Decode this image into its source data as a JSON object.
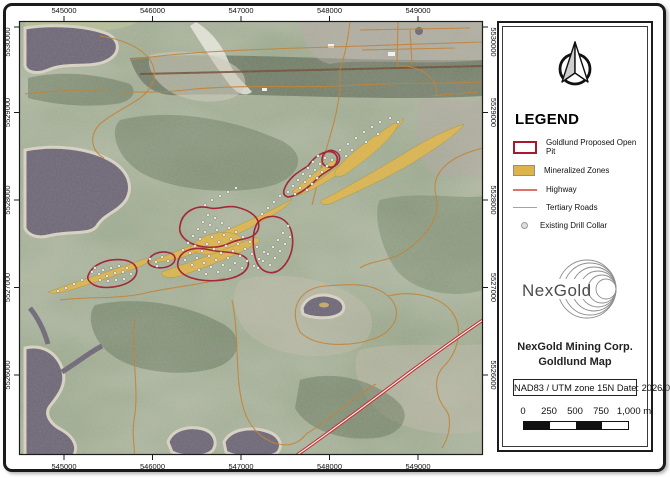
{
  "map": {
    "x_labels": [
      "545000",
      "546000",
      "547000",
      "548000",
      "549000"
    ],
    "y_labels": [
      "5530000",
      "5529000",
      "5528000",
      "5527000",
      "5526000"
    ],
    "features": {
      "tertiary_roads": [
        "M25,94 C80,86 130,96 185,90 C240,84 300,88 340,86 C400,82 450,84 483,82",
        "M130,60 C180,52 240,50 300,48 C360,46 420,44 483,42",
        "M100,36 C140,42 162,62 152,84 C144,102 118,108 100,124 C88,136 92,152 104,158",
        "M350,21 C348,40 344,58 340,70 L340,88 C338,110 332,130 326,150 C320,170 316,190 312,205",
        "M398,21 L397,66 C420,64 440,80 436,96",
        "M360,30 L470,28 M362,50 L455,48 M410,30 L412,64 M430,96 L478,92",
        "M483,148 C450,156 430,172 436,196 C442,218 424,238 404,252 C388,262 372,260 360,268",
        "M300,332 C288,308 300,288 325,286 C350,284 372,282 388,296 C404,310 396,330 376,338 C352,347 316,348 300,332",
        "M388,296 C412,290 440,296 452,312 C464,328 458,352 444,366 C432,378 436,398 446,410 C452,418 450,436 442,448",
        "M135,318 C130,352 140,388 134,420 C131,438 136,450 134,455",
        "M232,300 C240,338 234,378 244,410 C250,428 262,440 278,444 C292,447 300,442 306,434",
        "M306,434 C330,420 352,398 376,384",
        "M60,300 C90,296 120,300 150,292 C180,286 205,284 225,278"
      ],
      "highway": "M297,455 C330,432 370,402 410,372 C440,350 462,334 483,320",
      "mineralized_zones": [
        "M48,292 C70,284 100,274 130,264 C142,260 152,256 150,260 C146,266 120,274 96,282 C74,289 56,296 48,292 Z",
        "M150,262 C180,250 215,236 250,220 C268,212 288,202 292,199 C288,208 262,222 230,238 C198,254 166,264 150,262 Z",
        "M190,248 C200,234 220,230 236,234 C246,238 244,248 232,252 C216,257 196,256 190,248 Z",
        "M162,272 C190,262 220,252 248,240 C258,236 264,238 256,244 C236,256 204,268 180,276 C170,279 160,277 162,272 Z",
        "M296,196 C320,180 344,162 368,144 C380,134 396,124 404,118 C400,128 384,142 362,158 C340,174 312,192 296,196 Z",
        "M336,170 C350,152 372,138 390,126 C398,120 400,124 394,132 C382,148 360,164 346,174 C338,179 332,176 336,170 Z",
        "M322,200 C350,186 380,168 410,150 C432,136 452,128 464,124 C458,134 436,148 414,162 C388,178 352,194 332,203 C326,206 318,204 322,200 Z",
        "M292,192 C304,180 318,170 330,162 C336,158 338,161 333,167 C322,178 306,190 298,196 Z"
      ],
      "proposed_pits": [
        "M88,276 C92,264 108,258 124,260 C136,262 140,270 134,278 C126,287 104,290 94,285 C89,282 87,279 88,276 Z",
        "M148,262 C150,254 160,250 170,253 C176,255 177,261 171,265 C163,270 150,268 148,262 Z",
        "M180,226 C182,212 196,204 210,208 C218,210 226,205 236,207 C250,210 262,218 258,230 C254,240 240,238 230,243 C216,250 196,248 186,240 C180,235 179,230 180,226 Z",
        "M178,262 C180,250 194,246 210,250 C224,253 238,251 246,258 C252,265 246,274 232,278 C214,283 192,281 182,273 C178,269 177,266 178,262 Z",
        "M258,222 C270,212 286,216 291,230 C295,243 292,258 282,268 C272,277 260,272 256,260 C252,248 252,230 258,222 Z",
        "M284,190 C288,178 298,172 308,166 C312,160 318,154 326,152 C334,150 340,156 336,164 C332,170 324,172 318,178 C310,186 298,196 288,197 C284,196 283,193 284,190 Z",
        "M322,160 C322,152 330,148 336,152 C341,155 341,162 335,166 C329,169 322,166 322,160 Z"
      ],
      "drill_collars": [
        [
          95,
          268
        ],
        [
          99,
          274
        ],
        [
          103,
          270
        ],
        [
          107,
          276
        ],
        [
          111,
          268
        ],
        [
          115,
          273
        ],
        [
          119,
          266
        ],
        [
          123,
          272
        ],
        [
          127,
          268
        ],
        [
          131,
          274
        ],
        [
          108,
          281
        ],
        [
          116,
          280
        ],
        [
          124,
          279
        ],
        [
          100,
          280
        ],
        [
          92,
          272
        ],
        [
          66,
          288
        ],
        [
          74,
          284
        ],
        [
          82,
          280
        ],
        [
          58,
          291
        ],
        [
          150,
          259
        ],
        [
          156,
          262
        ],
        [
          162,
          257
        ],
        [
          168,
          261
        ],
        [
          157,
          266
        ],
        [
          183,
          250
        ],
        [
          188,
          243
        ],
        [
          193,
          236
        ],
        [
          198,
          229
        ],
        [
          203,
          222
        ],
        [
          208,
          215
        ],
        [
          185,
          260
        ],
        [
          190,
          253
        ],
        [
          195,
          246
        ],
        [
          200,
          239
        ],
        [
          205,
          232
        ],
        [
          210,
          225
        ],
        [
          215,
          218
        ],
        [
          192,
          265
        ],
        [
          197,
          258
        ],
        [
          202,
          251
        ],
        [
          207,
          244
        ],
        [
          212,
          237
        ],
        [
          217,
          230
        ],
        [
          222,
          223
        ],
        [
          199,
          270
        ],
        [
          204,
          263
        ],
        [
          209,
          256
        ],
        [
          214,
          249
        ],
        [
          219,
          242
        ],
        [
          224,
          235
        ],
        [
          229,
          228
        ],
        [
          206,
          274
        ],
        [
          211,
          267
        ],
        [
          216,
          260
        ],
        [
          221,
          253
        ],
        [
          226,
          246
        ],
        [
          231,
          239
        ],
        [
          236,
          232
        ],
        [
          218,
          272
        ],
        [
          223,
          265
        ],
        [
          228,
          258
        ],
        [
          233,
          251
        ],
        [
          238,
          244
        ],
        [
          243,
          237
        ],
        [
          230,
          270
        ],
        [
          235,
          263
        ],
        [
          240,
          256
        ],
        [
          245,
          249
        ],
        [
          250,
          242
        ],
        [
          242,
          268
        ],
        [
          247,
          261
        ],
        [
          252,
          254
        ],
        [
          257,
          247
        ],
        [
          254,
          266
        ],
        [
          259,
          259
        ],
        [
          264,
          252
        ],
        [
          258,
          268
        ],
        [
          263,
          261
        ],
        [
          268,
          254
        ],
        [
          273,
          247
        ],
        [
          278,
          240
        ],
        [
          283,
          233
        ],
        [
          288,
          226
        ],
        [
          270,
          265
        ],
        [
          275,
          258
        ],
        [
          280,
          251
        ],
        [
          285,
          244
        ],
        [
          290,
          237
        ],
        [
          288,
          192
        ],
        [
          293,
          186
        ],
        [
          298,
          180
        ],
        [
          303,
          174
        ],
        [
          308,
          168
        ],
        [
          313,
          162
        ],
        [
          318,
          156
        ],
        [
          295,
          194
        ],
        [
          300,
          188
        ],
        [
          305,
          182
        ],
        [
          310,
          176
        ],
        [
          315,
          170
        ],
        [
          320,
          164
        ],
        [
          325,
          158
        ],
        [
          307,
          190
        ],
        [
          312,
          184
        ],
        [
          317,
          178
        ],
        [
          322,
          172
        ],
        [
          327,
          166
        ],
        [
          332,
          160
        ],
        [
          340,
          150
        ],
        [
          348,
          144
        ],
        [
          356,
          138
        ],
        [
          364,
          132
        ],
        [
          372,
          127
        ],
        [
          380,
          122
        ],
        [
          390,
          118
        ],
        [
          352,
          150
        ],
        [
          366,
          142
        ],
        [
          378,
          134
        ],
        [
          398,
          122
        ],
        [
          346,
          156
        ],
        [
          268,
          208
        ],
        [
          274,
          202
        ],
        [
          280,
          196
        ],
        [
          262,
          214
        ],
        [
          205,
          205
        ],
        [
          212,
          200
        ],
        [
          220,
          196
        ],
        [
          228,
          192
        ],
        [
          236,
          188
        ]
      ]
    }
  },
  "legend": {
    "title": "LEGEND",
    "items": [
      {
        "label": "Goldlund Proposed Open Pit",
        "symbol": "pit-outline",
        "color": "#a6192e"
      },
      {
        "label": "Mineralized Zones",
        "symbol": "zone-fill",
        "color": "#dcb44c"
      },
      {
        "label": "Highway",
        "symbol": "highway-line",
        "color": "#e0706a"
      },
      {
        "label": "Tertiary Roads",
        "symbol": "road-line",
        "color": "#d19c52"
      },
      {
        "label": "Existing Drill Collar",
        "symbol": "drill-dot",
        "color": "#dedede"
      }
    ]
  },
  "panel": {
    "logo_text": "NexGold",
    "title_line1": "NexGold Mining Corp.",
    "title_line2": "Goldlund Map",
    "crs_line": "NAD83 / UTM zone 15N Date: 2026/01/26",
    "scale_labels": [
      "0",
      "250",
      "500",
      "750",
      "1,000 m"
    ]
  }
}
